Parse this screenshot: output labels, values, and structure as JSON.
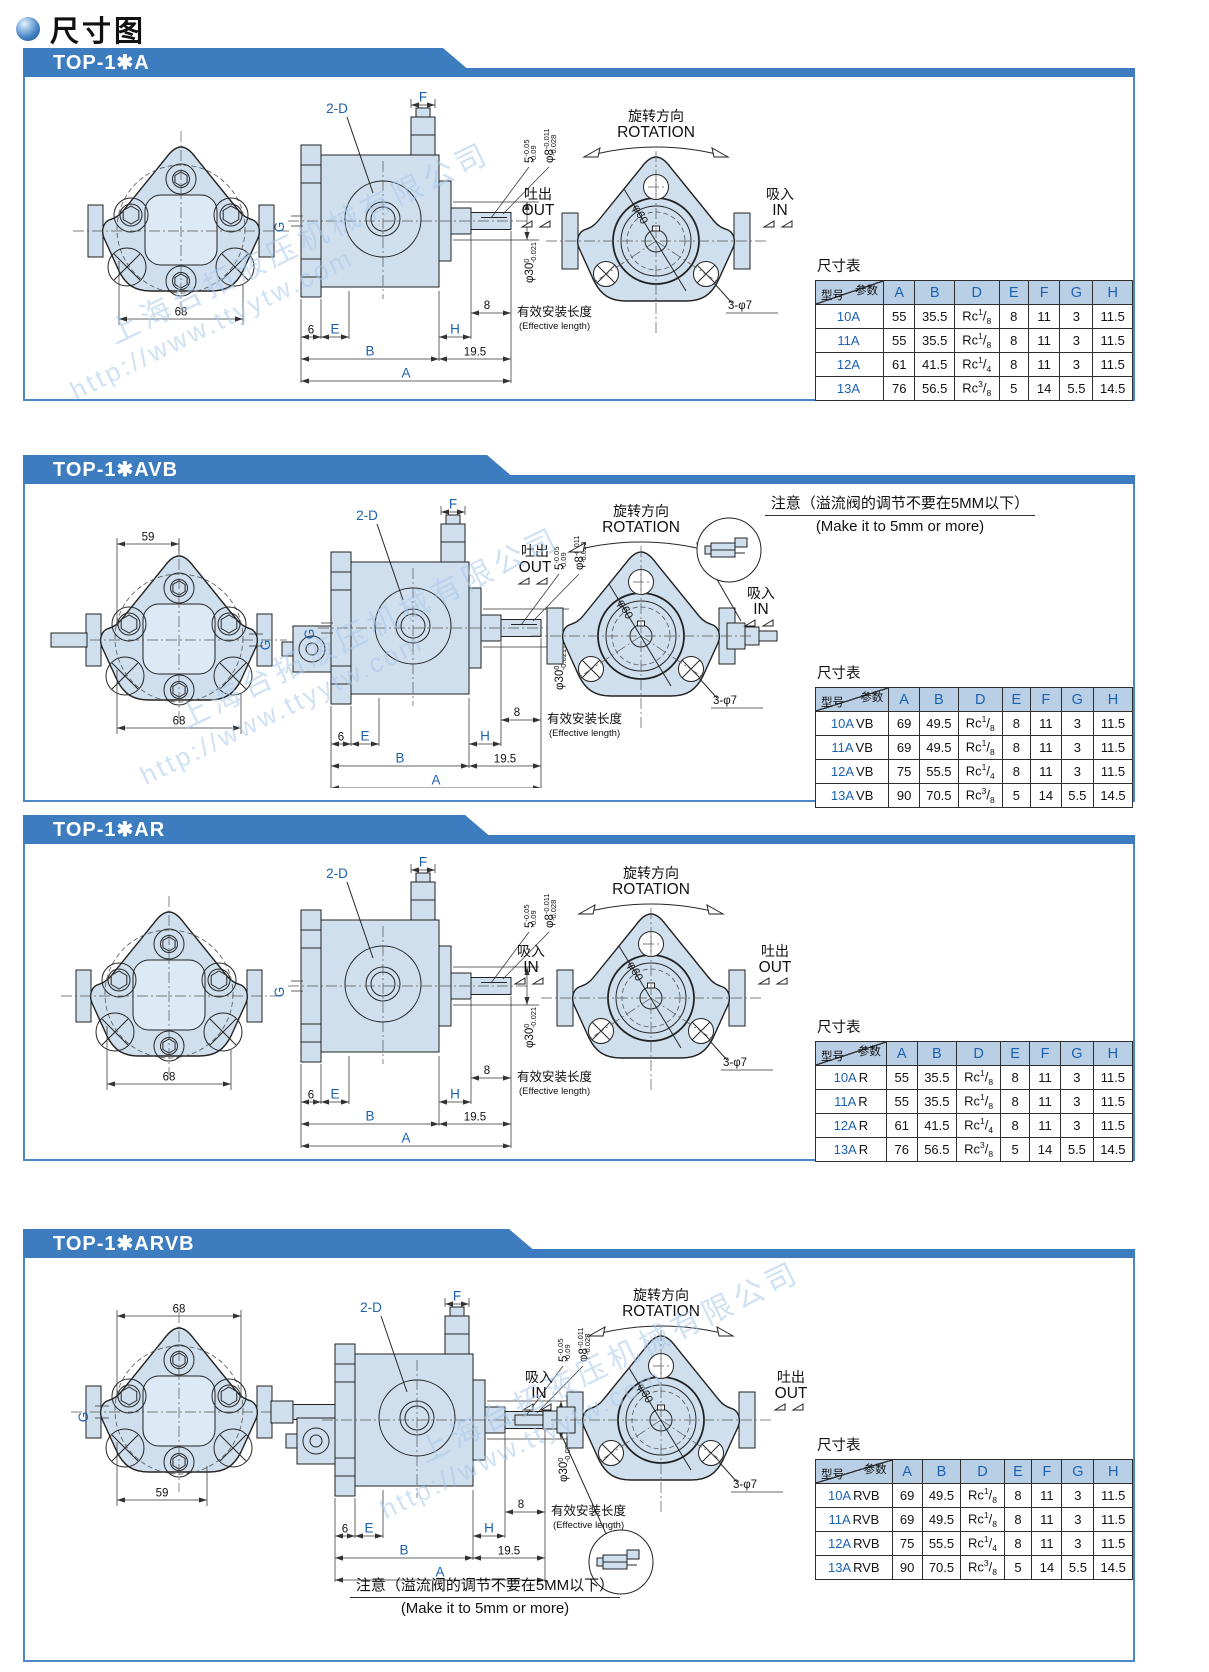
{
  "page": {
    "title": "尺寸图"
  },
  "watermark": {
    "company": "上海台拓液压机械有限公司",
    "url": "http://www.ttyytw.com"
  },
  "shared": {
    "table_title": "尺寸表",
    "param_label": "参数",
    "model_label": "型号",
    "columns": [
      "A",
      "B",
      "D",
      "E",
      "F",
      "G",
      "H"
    ],
    "rotation_cn": "旋转方向",
    "rotation_en": "ROTATION",
    "out_cn": "吐出",
    "out_en": "OUT",
    "in_cn": "吸入",
    "in_en": "IN",
    "phi60": "φ60",
    "bolt_holes": "3-φ7",
    "labels": {
      "F": "F",
      "twoD": "2-D",
      "G": "G",
      "six": "6",
      "E": "E",
      "H": "H",
      "B": "B",
      "A": "A",
      "n195": "19.5",
      "eff_num": "8",
      "eff_cn": "有效安装长度",
      "eff_en": "(Effective length)"
    },
    "tols": {
      "shaft_len": {
        "base": "5",
        "hi": "-0.05",
        "lo": "-0.09"
      },
      "shaft_dia": {
        "base": "φ8",
        "hi": "-0.011",
        "lo": "-0.028"
      },
      "pilot": {
        "base": "φ30",
        "hi": "0",
        "lo": "-0.021"
      }
    }
  },
  "sections": [
    {
      "id": "top-1a",
      "header": "TOP-1✱A",
      "front": {
        "dim_bottom": "68"
      },
      "side": {
        "g": true,
        "valve": false
      },
      "mount": {
        "out": "left",
        "in": "right"
      },
      "note": null,
      "rows": [
        [
          "10A",
          "",
          "55",
          "35.5",
          "Rc1/8",
          "8",
          "11",
          "3",
          "11.5"
        ],
        [
          "11A",
          "",
          "55",
          "35.5",
          "Rc1/8",
          "8",
          "11",
          "3",
          "11.5"
        ],
        [
          "12A",
          "",
          "61",
          "41.5",
          "Rc1/4",
          "8",
          "11",
          "3",
          "11.5"
        ],
        [
          "13A",
          "",
          "76",
          "56.5",
          "Rc3/8",
          "5",
          "14",
          "5.5",
          "14.5"
        ]
      ]
    },
    {
      "id": "top-1avb",
      "header": "TOP-1✱AVB",
      "front": {
        "dim_top": "59",
        "dim_top_w": 0,
        "dim_bottom": "68",
        "shaft": "left",
        "g": "right"
      },
      "side": {
        "g": true,
        "valve": true
      },
      "mount": {
        "out": "top-left",
        "in": "right"
      },
      "note": {
        "cn": "注意（溢流阀的调节不要在5MM以下）",
        "en": "(Make it to 5mm or more)"
      },
      "rows": [
        [
          "10A",
          "VB",
          "69",
          "49.5",
          "Rc1/8",
          "8",
          "11",
          "3",
          "11.5"
        ],
        [
          "11A",
          "VB",
          "69",
          "49.5",
          "Rc1/8",
          "8",
          "11",
          "3",
          "11.5"
        ],
        [
          "12A",
          "VB",
          "75",
          "55.5",
          "Rc1/4",
          "8",
          "11",
          "3",
          "11.5"
        ],
        [
          "13A",
          "VB",
          "90",
          "70.5",
          "Rc3/8",
          "5",
          "14",
          "5.5",
          "14.5"
        ]
      ]
    },
    {
      "id": "top-1ar",
      "header": "TOP-1✱AR",
      "front": {
        "dim_bottom": "68"
      },
      "side": {
        "g": true,
        "valve": false
      },
      "mount": {
        "in": "left",
        "out": "right"
      },
      "note": null,
      "rows": [
        [
          "10A",
          "R",
          "55",
          "35.5",
          "Rc1/8",
          "8",
          "11",
          "3",
          "11.5"
        ],
        [
          "11A",
          "R",
          "55",
          "35.5",
          "Rc1/8",
          "8",
          "11",
          "3",
          "11.5"
        ],
        [
          "12A",
          "R",
          "61",
          "41.5",
          "Rc1/4",
          "8",
          "11",
          "3",
          "11.5"
        ],
        [
          "13A",
          "R",
          "76",
          "56.5",
          "Rc3/8",
          "5",
          "14",
          "5.5",
          "14.5"
        ]
      ]
    },
    {
      "id": "top-1arvb",
      "header": "TOP-1✱ARVB",
      "front": {
        "dim_top": "68",
        "dim_bottom": "59",
        "dim_bot_w": 28,
        "shaft": "right",
        "dim19": "19",
        "g": "left"
      },
      "side": {
        "g": false,
        "valve": true
      },
      "mount": {
        "in": "left",
        "out": "right"
      },
      "note": {
        "cn": "注意（溢流阀的调节不要在5MM以下）",
        "en": "(Make it to 5mm or more)"
      },
      "rows": [
        [
          "10A",
          "RVB",
          "69",
          "49.5",
          "Rc1/8",
          "8",
          "11",
          "3",
          "11.5"
        ],
        [
          "11A",
          "RVB",
          "69",
          "49.5",
          "Rc1/8",
          "8",
          "11",
          "3",
          "11.5"
        ],
        [
          "12A",
          "RVB",
          "75",
          "55.5",
          "Rc1/4",
          "8",
          "11",
          "3",
          "11.5"
        ],
        [
          "13A",
          "RVB",
          "90",
          "70.5",
          "Rc3/8",
          "5",
          "14",
          "5.5",
          "14.5"
        ]
      ]
    }
  ]
}
